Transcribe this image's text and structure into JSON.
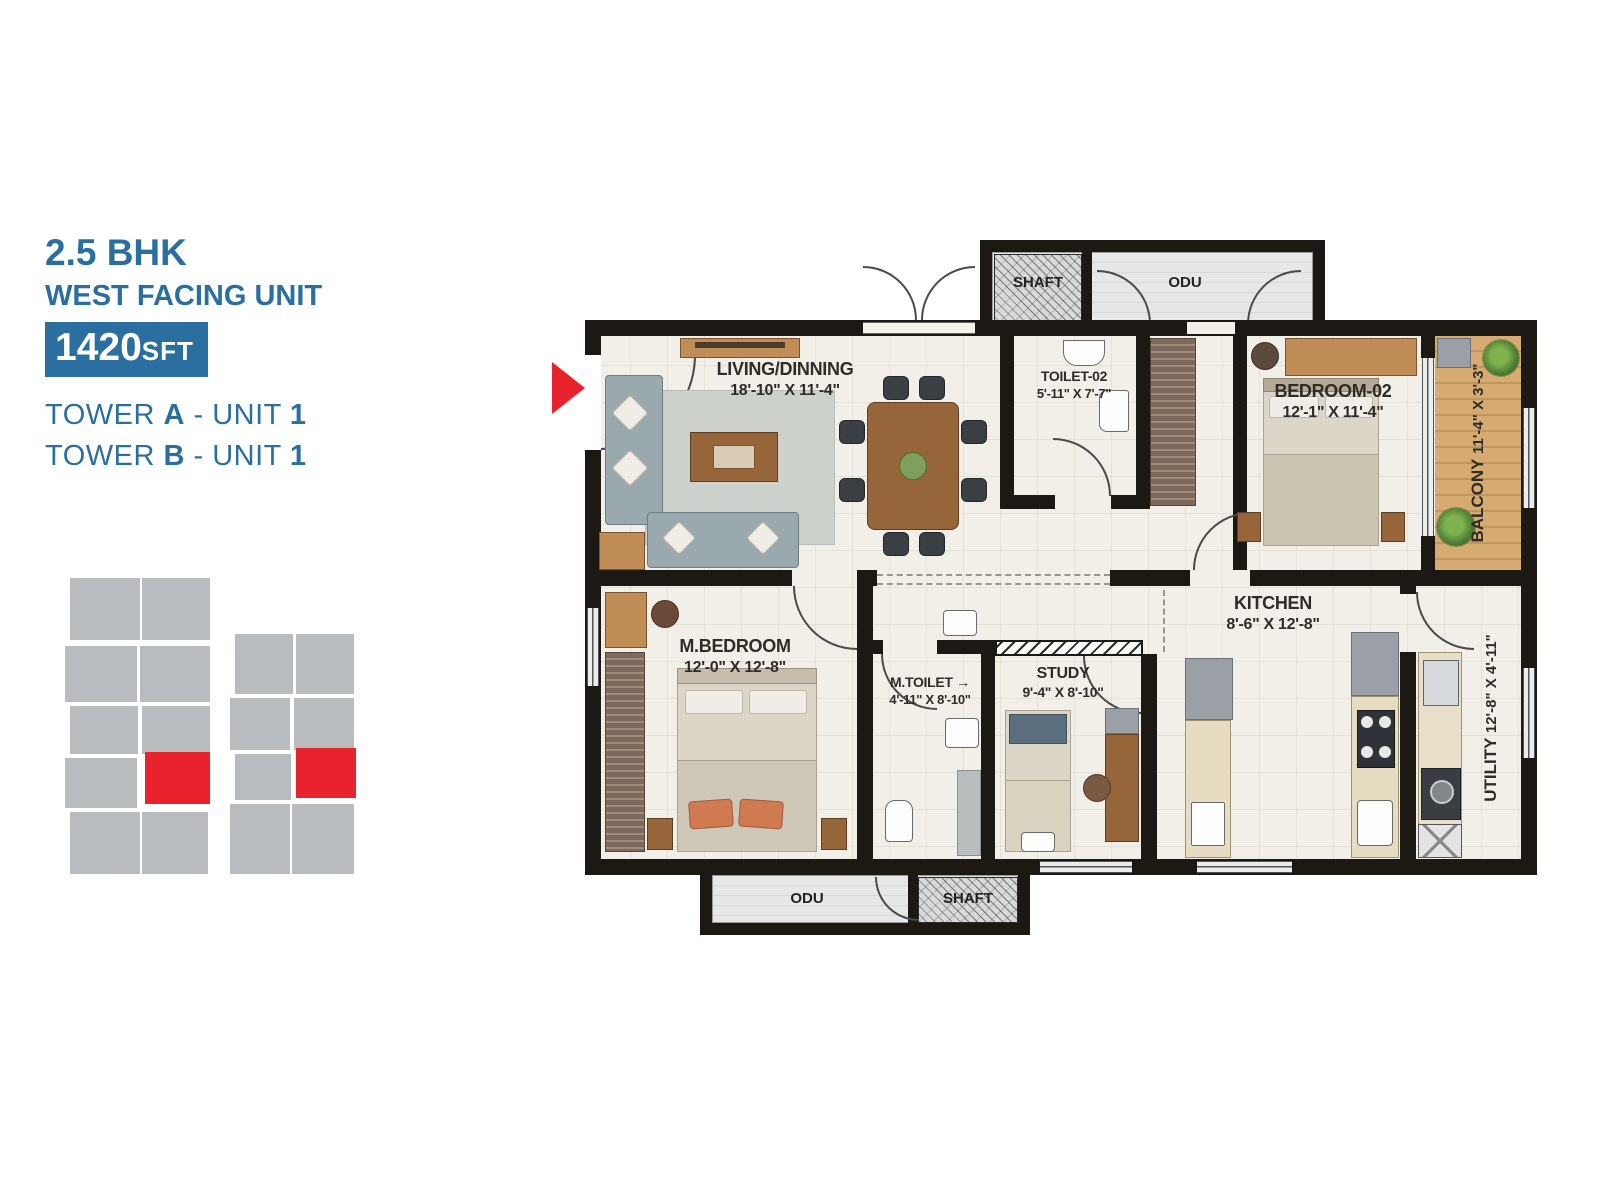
{
  "colors": {
    "accent_blue": "#2a6f9f",
    "highlight_red": "#e8232e",
    "wall": "#1c1814",
    "floor": "#f2efe8",
    "wood": "#bf8d55",
    "wood_dark": "#96653a",
    "counter": "#e6dcc2",
    "keyplan_gray": "#b9bcbe",
    "sofa_gray": "#9aa9ae"
  },
  "info": {
    "bhk": "2.5 BHK",
    "facing": "WEST FACING UNIT",
    "area_value": "1420",
    "area_unit": "SFT",
    "towers": [
      {
        "pre": "TOWER ",
        "tower": "A",
        "mid": " - UNIT ",
        "unit": "1"
      },
      {
        "pre": "TOWER ",
        "tower": "B",
        "mid": " - UNIT ",
        "unit": "1"
      }
    ]
  },
  "plan": {
    "entrance_label": "ENT",
    "mtoilet_arrow": "→",
    "rooms": {
      "living": {
        "name": "LIVING/DINNING",
        "dims": "18'-10\" X 11'-4\""
      },
      "toilet02": {
        "name": "TOILET-02",
        "dims": "5'-11\" X 7'-7\""
      },
      "bedroom02": {
        "name": "BEDROOM-02",
        "dims": "12'-1\" X 11'-4\""
      },
      "balcony": {
        "name": "BALCONY",
        "dims": "11'-4\" X 3'-3\""
      },
      "kitchen": {
        "name": "KITCHEN",
        "dims": "8'-6\" X 12'-8\""
      },
      "mbedroom": {
        "name": "M.BEDROOM",
        "dims": "12'-0\" X 12'-8\""
      },
      "mtoilet": {
        "name": "M.TOILET",
        "dims": "4'-11\" X 8'-10\""
      },
      "study": {
        "name": "STUDY",
        "dims": "9'-4\" X 8'-10\""
      },
      "utility": {
        "name": "UTILITY",
        "dims": "12'-8\" X 4'-11\""
      },
      "shaft_top": {
        "name": "SHAFT"
      },
      "odu_top": {
        "name": "ODU"
      },
      "odu_bottom": {
        "name": "ODU"
      },
      "shaft_bottom": {
        "name": "SHAFT"
      }
    }
  }
}
